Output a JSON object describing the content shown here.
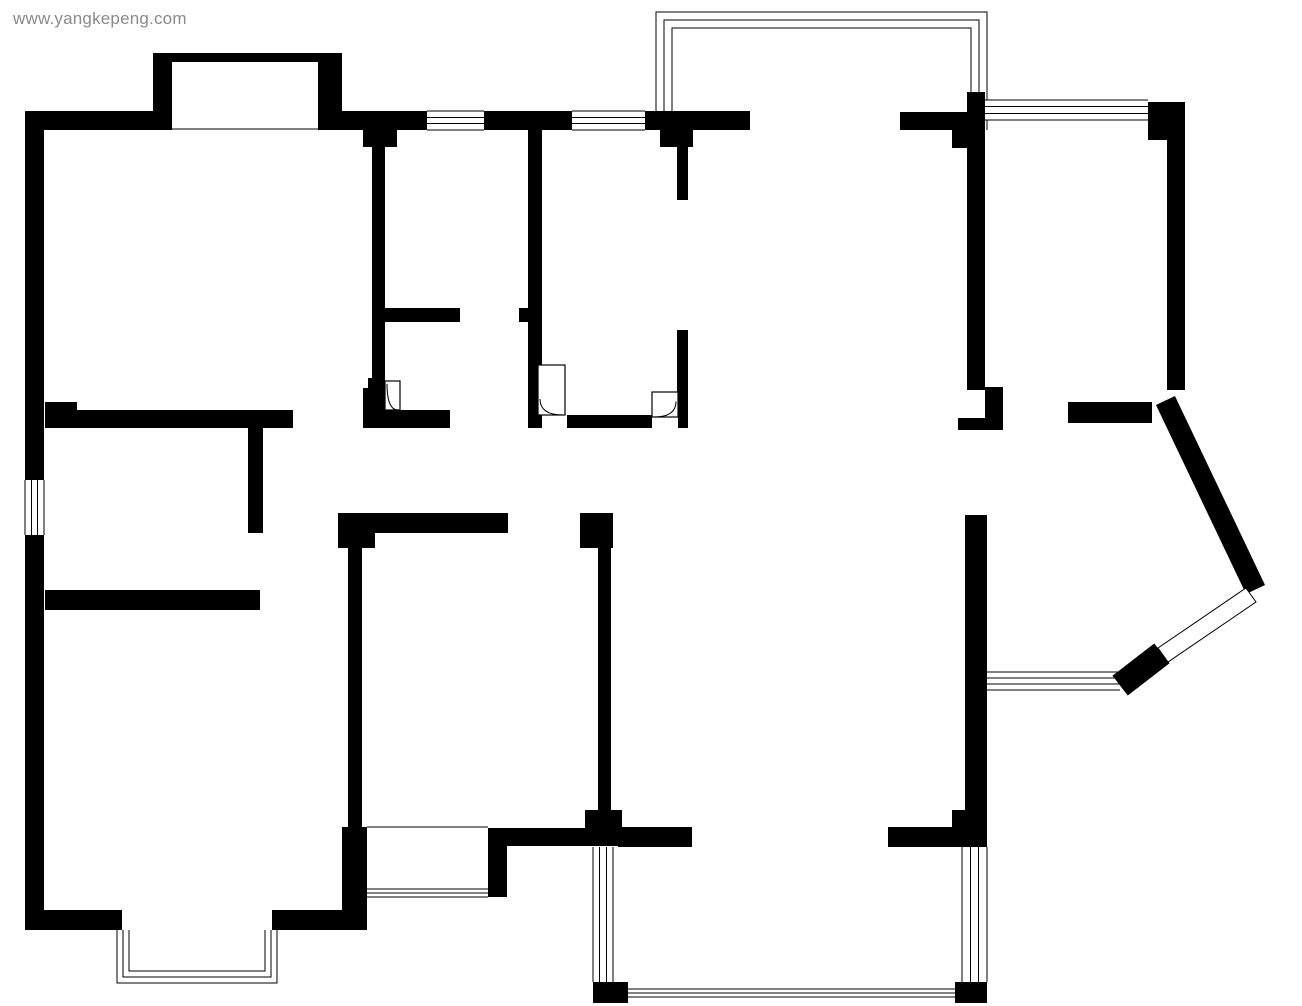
{
  "canvas": {
    "width": 1302,
    "height": 1006,
    "background": "#ffffff"
  },
  "watermark": {
    "text": "www.yangkepeng.com",
    "color": "#8a8a8a"
  },
  "plan": {
    "wall_color": "#000000",
    "line_color": "#000000",
    "walls": [
      {
        "x": 25,
        "y": 111,
        "w": 19,
        "h": 369
      },
      {
        "x": 25,
        "y": 535,
        "w": 19,
        "h": 395
      },
      {
        "x": 25,
        "y": 111,
        "w": 128,
        "h": 19
      },
      {
        "x": 153,
        "y": 53,
        "w": 189,
        "h": 9
      },
      {
        "x": 153,
        "y": 53,
        "w": 19,
        "h": 77
      },
      {
        "x": 318,
        "y": 53,
        "w": 24,
        "h": 77
      },
      {
        "x": 342,
        "y": 111,
        "w": 85,
        "h": 19
      },
      {
        "x": 484,
        "y": 111,
        "w": 88,
        "h": 19
      },
      {
        "x": 645,
        "y": 111,
        "w": 105,
        "h": 19
      },
      {
        "x": 900,
        "y": 112,
        "w": 67,
        "h": 18
      },
      {
        "x": 952,
        "y": 130,
        "w": 15,
        "h": 18
      },
      {
        "x": 967,
        "y": 92,
        "w": 18,
        "h": 51
      },
      {
        "x": 967,
        "y": 143,
        "w": 18,
        "h": 247
      },
      {
        "x": 985,
        "y": 387,
        "w": 18,
        "h": 36
      },
      {
        "x": 958,
        "y": 418,
        "w": 45,
        "h": 12
      },
      {
        "x": 1148,
        "y": 102,
        "w": 37,
        "h": 38
      },
      {
        "x": 1167,
        "y": 140,
        "w": 18,
        "h": 250
      },
      {
        "x": 1068,
        "y": 402,
        "w": 84,
        "h": 21
      },
      {
        "x": 965,
        "y": 515,
        "w": 22,
        "h": 330
      },
      {
        "x": 952,
        "y": 810,
        "w": 35,
        "h": 37
      },
      {
        "x": 888,
        "y": 827,
        "w": 64,
        "h": 20
      },
      {
        "x": 618,
        "y": 827,
        "w": 74,
        "h": 20
      },
      {
        "x": 585,
        "y": 810,
        "w": 37,
        "h": 18
      },
      {
        "x": 507,
        "y": 828,
        "w": 113,
        "h": 18
      },
      {
        "x": 598,
        "y": 548,
        "w": 13,
        "h": 262
      },
      {
        "x": 580,
        "y": 513,
        "w": 33,
        "h": 35
      },
      {
        "x": 338,
        "y": 513,
        "w": 170,
        "h": 20
      },
      {
        "x": 338,
        "y": 513,
        "w": 37,
        "h": 35
      },
      {
        "x": 348,
        "y": 548,
        "w": 14,
        "h": 279
      },
      {
        "x": 342,
        "y": 827,
        "w": 25,
        "h": 101
      },
      {
        "x": 488,
        "y": 828,
        "w": 19,
        "h": 69
      },
      {
        "x": 25,
        "y": 910,
        "w": 97,
        "h": 20
      },
      {
        "x": 272,
        "y": 910,
        "w": 95,
        "h": 20
      },
      {
        "x": 45,
        "y": 402,
        "w": 32,
        "h": 8
      },
      {
        "x": 45,
        "y": 410,
        "w": 248,
        "h": 18
      },
      {
        "x": 363,
        "y": 410,
        "w": 87,
        "h": 18
      },
      {
        "x": 248,
        "y": 428,
        "w": 15,
        "h": 105
      },
      {
        "x": 45,
        "y": 590,
        "w": 215,
        "h": 20
      },
      {
        "x": 368,
        "y": 378,
        "w": 17,
        "h": 10
      },
      {
        "x": 363,
        "y": 388,
        "w": 22,
        "h": 22
      },
      {
        "x": 363,
        "y": 130,
        "w": 34,
        "h": 17
      },
      {
        "x": 372,
        "y": 147,
        "w": 13,
        "h": 270
      },
      {
        "x": 385,
        "y": 308,
        "w": 75,
        "h": 14
      },
      {
        "x": 519,
        "y": 308,
        "w": 9,
        "h": 14
      },
      {
        "x": 528,
        "y": 130,
        "w": 14,
        "h": 298
      },
      {
        "x": 567,
        "y": 415,
        "w": 85,
        "h": 13
      },
      {
        "x": 678,
        "y": 415,
        "w": 10,
        "h": 13
      },
      {
        "x": 660,
        "y": 130,
        "w": 33,
        "h": 17
      },
      {
        "x": 677,
        "y": 147,
        "w": 11,
        "h": 53
      },
      {
        "x": 677,
        "y": 330,
        "w": 11,
        "h": 85
      },
      {
        "x": 593,
        "y": 982,
        "w": 35,
        "h": 21
      },
      {
        "x": 955,
        "y": 982,
        "w": 32,
        "h": 21
      }
    ],
    "windows": [
      {
        "x": 427,
        "y": 111,
        "w": 57,
        "h": 19,
        "dir": "h",
        "lines": 4
      },
      {
        "x": 572,
        "y": 111,
        "w": 73,
        "h": 19,
        "dir": "h",
        "lines": 4
      },
      {
        "x": 985,
        "y": 100,
        "w": 163,
        "h": 20,
        "dir": "h",
        "lines": 4
      },
      {
        "x": 25,
        "y": 480,
        "w": 19,
        "h": 55,
        "dir": "v",
        "lines": 4
      },
      {
        "x": 985,
        "y": 672,
        "w": 135,
        "h": 18,
        "dir": "h",
        "lines": 4
      },
      {
        "x": 593,
        "y": 847,
        "w": 20,
        "h": 135,
        "dir": "v",
        "lines": 4
      },
      {
        "x": 962,
        "y": 847,
        "w": 25,
        "h": 135,
        "dir": "v",
        "lines": 4
      },
      {
        "x": 628,
        "y": 989,
        "w": 327,
        "h": 8,
        "dir": "h",
        "lines": 3
      },
      {
        "x": 362,
        "y": 889,
        "w": 126,
        "h": 8,
        "dir": "h",
        "lines": 3
      }
    ],
    "rails": [
      {
        "open": "bottom",
        "rects": [
          [
            656,
            12,
            331,
            118
          ],
          [
            664,
            20,
            315,
            110
          ],
          [
            672,
            28,
            299,
            102
          ]
        ]
      },
      {
        "open": "top",
        "rects": [
          [
            117,
            930,
            160,
            53
          ],
          [
            123,
            930,
            148,
            47
          ],
          [
            129,
            930,
            136,
            41
          ]
        ]
      }
    ],
    "lines": [
      [
        367,
        827,
        488,
        827
      ],
      [
        172,
        129,
        318,
        129
      ]
    ],
    "doors": [
      {
        "x": 385,
        "y": 381,
        "w": 15,
        "h": 29,
        "hinge": "l",
        "sf": 0.1
      },
      {
        "x": 538,
        "y": 365,
        "w": 27,
        "h": 50,
        "hinge": "l",
        "sf": 0.68
      },
      {
        "x": 652,
        "y": 392,
        "w": 26,
        "h": 25,
        "hinge": "r",
        "sf": 0.38
      }
    ],
    "diag_walls": [
      {
        "x1": 1170,
        "y1": 410,
        "x2": 1251,
        "y2": 580,
        "w": 21
      },
      {
        "x1": 1130,
        "y1": 678,
        "x2": 1152,
        "y2": 661,
        "w": 25
      }
    ],
    "diag_bands": [
      {
        "points": [
          [
            1246,
            588
          ],
          [
            1256,
            602
          ],
          [
            1168,
            662
          ],
          [
            1158,
            648
          ]
        ]
      }
    ]
  }
}
